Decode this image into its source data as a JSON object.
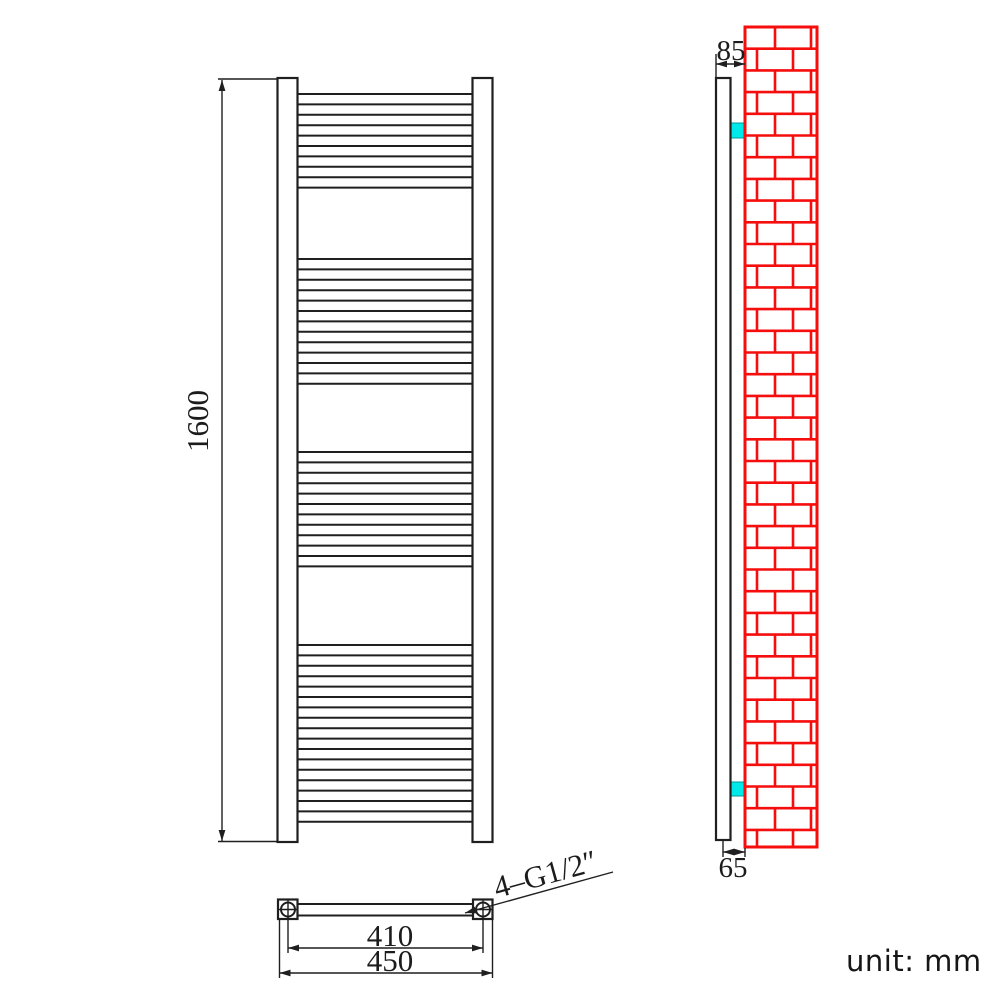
{
  "unit_note": "unit: mm",
  "labels": {
    "height": "1600",
    "inner_width": "410",
    "outer_width": "450",
    "thread": "4–G1/2″",
    "depth_total": "85",
    "depth_bottom": "65"
  },
  "colors": {
    "line": "#1f1f1f",
    "wall_red": "#f60d0d",
    "bracket_cyan": "#00e8e8",
    "bracket_edge": "#009999",
    "text": "#1c1c1c"
  },
  "geometry": {
    "front": {
      "post_left_x": 277.5,
      "post_right_x": 472.5,
      "post_w": 20,
      "top": 78,
      "bottom": 842,
      "rail_x1": 297.5,
      "rail_x2": 472.5,
      "rail_pitch": 10.4,
      "rail_groups": [
        [
          94,
          10
        ],
        [
          259,
          13
        ],
        [
          452,
          12
        ],
        [
          645,
          18
        ]
      ]
    },
    "side": {
      "profile": [
        716,
        78,
        14.5,
        762
      ],
      "wall": [
        745,
        27,
        72,
        820
      ],
      "brick_row_h": 21.7,
      "joints_even": [
        30,
        66
      ],
      "joints_odd": [
        12,
        48
      ],
      "brackets": [
        [
          730.5,
          123,
          14.5,
          15
        ],
        [
          730.5,
          782,
          14.5,
          14
        ]
      ]
    },
    "plan": {
      "squares": [
        [
          278,
          899.5,
          19.5
        ],
        [
          473,
          899.5,
          19.5
        ]
      ],
      "circles": [
        [
          288,
          909.5
        ],
        [
          483,
          909.5
        ]
      ],
      "circle_r": 7,
      "bar": [
        297.5,
        904,
        473,
        915.5
      ]
    },
    "dims": {
      "height": {
        "line": [
          222,
          80,
          222,
          841
        ],
        "ext": [
          [
            218,
            79,
            277,
            79
          ],
          [
            218,
            841.5,
            277,
            841.5
          ]
        ],
        "arrows": [
          [
            222,
            80,
            90
          ],
          [
            222,
            841,
            -90
          ]
        ]
      },
      "inner": {
        "line": [
          288,
          948,
          483,
          948
        ],
        "ext": [
          [
            288,
            917,
            288,
            953
          ],
          [
            483,
            917,
            483,
            953
          ]
        ],
        "arrows": [
          [
            288,
            948,
            0
          ],
          [
            483,
            948,
            180
          ]
        ]
      },
      "outer": {
        "line": [
          279.5,
          973,
          492.5,
          973
        ],
        "ext": [
          [
            279.5,
            920,
            279.5,
            978
          ],
          [
            492.5,
            920,
            492.5,
            978
          ]
        ],
        "arrows": [
          [
            279.5,
            973,
            0
          ],
          [
            492.5,
            973,
            180
          ]
        ]
      },
      "depth": {
        "line": [
          716,
          64,
          745,
          64
        ],
        "ext": [
          [
            716,
            54,
            716,
            78
          ]
        ],
        "arrows": [
          [
            716,
            64,
            0
          ],
          [
            745,
            64,
            180
          ]
        ]
      },
      "bottom_depth": {
        "line": [
          723,
          852,
          745,
          852
        ],
        "ext": [
          [
            723,
            841,
            723,
            857
          ],
          [
            745,
            848,
            745,
            857
          ]
        ],
        "arrows": [
          [
            723,
            852,
            0
          ],
          [
            745,
            852,
            180
          ]
        ]
      },
      "leader": {
        "line": [
          465,
          913,
          613,
          872
        ],
        "ext": [],
        "arrows": [
          [
            465,
            913,
            -15.5
          ]
        ]
      }
    }
  }
}
